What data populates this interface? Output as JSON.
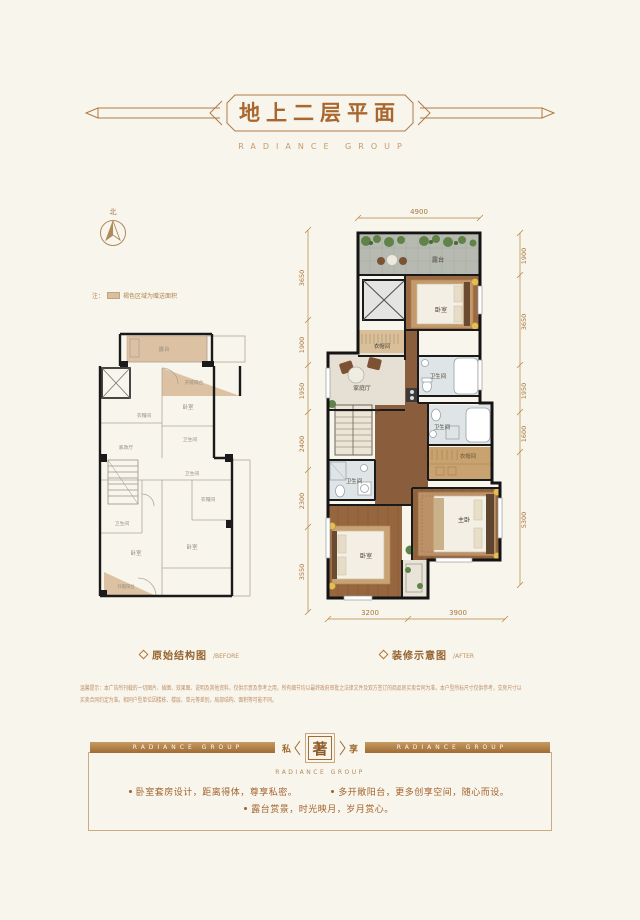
{
  "header": {
    "title": "地上二层平面",
    "subtitle": "RADIANCE GROUP"
  },
  "compass": {
    "label": "北"
  },
  "legend_note": {
    "prefix": "注：",
    "text": "褐色区域为赠送面积"
  },
  "plans": {
    "before": {
      "caption": "原始结构图",
      "caption_en": "/BEFORE",
      "rooms": [
        "露台",
        "开敞阳台",
        "卧室",
        "衣帽间",
        "卫生间",
        "家政厅",
        "卫生间",
        "衣帽间",
        "卫生间",
        "卧室",
        "卧室",
        "开敞阳台"
      ]
    },
    "after": {
      "caption": "装修示意图",
      "caption_en": "/AFTER",
      "rooms": [
        "露台",
        "卧室",
        "衣帽间",
        "家庭厅",
        "卫生间",
        "下",
        "卫生间",
        "衣帽间",
        "卫生间",
        "主卧",
        "卧室"
      ],
      "dimensions": {
        "top": [
          "4900"
        ],
        "left": [
          "3650",
          "1900",
          "1950",
          "2400",
          "2300",
          "3550"
        ],
        "right": [
          "1900",
          "3650",
          "1950",
          "1600",
          "5300"
        ],
        "bottom": [
          "3200",
          "3900"
        ]
      }
    }
  },
  "disclaimer": {
    "line1": "温馨提示：本广告所刊载的一切图片、插图、效果图、说明及其他资料，仅供示意及参考之用，所有细节均以最终政府审批之法律文件及双方签订的商品房买卖合同为准。本户型所标尺寸仅供参考，交房尺寸以",
    "line2": "买卖合同约定为准。相同户型单位因楼栋、楼层、单元等差别，局部结构、面积等可能不同。"
  },
  "footer": {
    "ribbon_left": "RADIANCE GROUP",
    "ribbon_right": "RADIANCE GROUP",
    "emblem": {
      "left": "私",
      "center": "著",
      "right": "享",
      "subtitle": "RADIANCE GROUP"
    },
    "bullets": [
      "卧室套房设计，距离得体，尊享私密。",
      "多开敞阳台，更多创享空间，随心而设。",
      "露台赏景，时光映月，岁月赏心。"
    ]
  },
  "colors": {
    "background": "#f8f5ec",
    "accent": "#a9702f",
    "accent_light": "#c39b6d",
    "bonus_area": "#dcc2a2",
    "wall": "#1a1a1a",
    "wood": "#93643f",
    "ribbon": "#b07c42"
  }
}
